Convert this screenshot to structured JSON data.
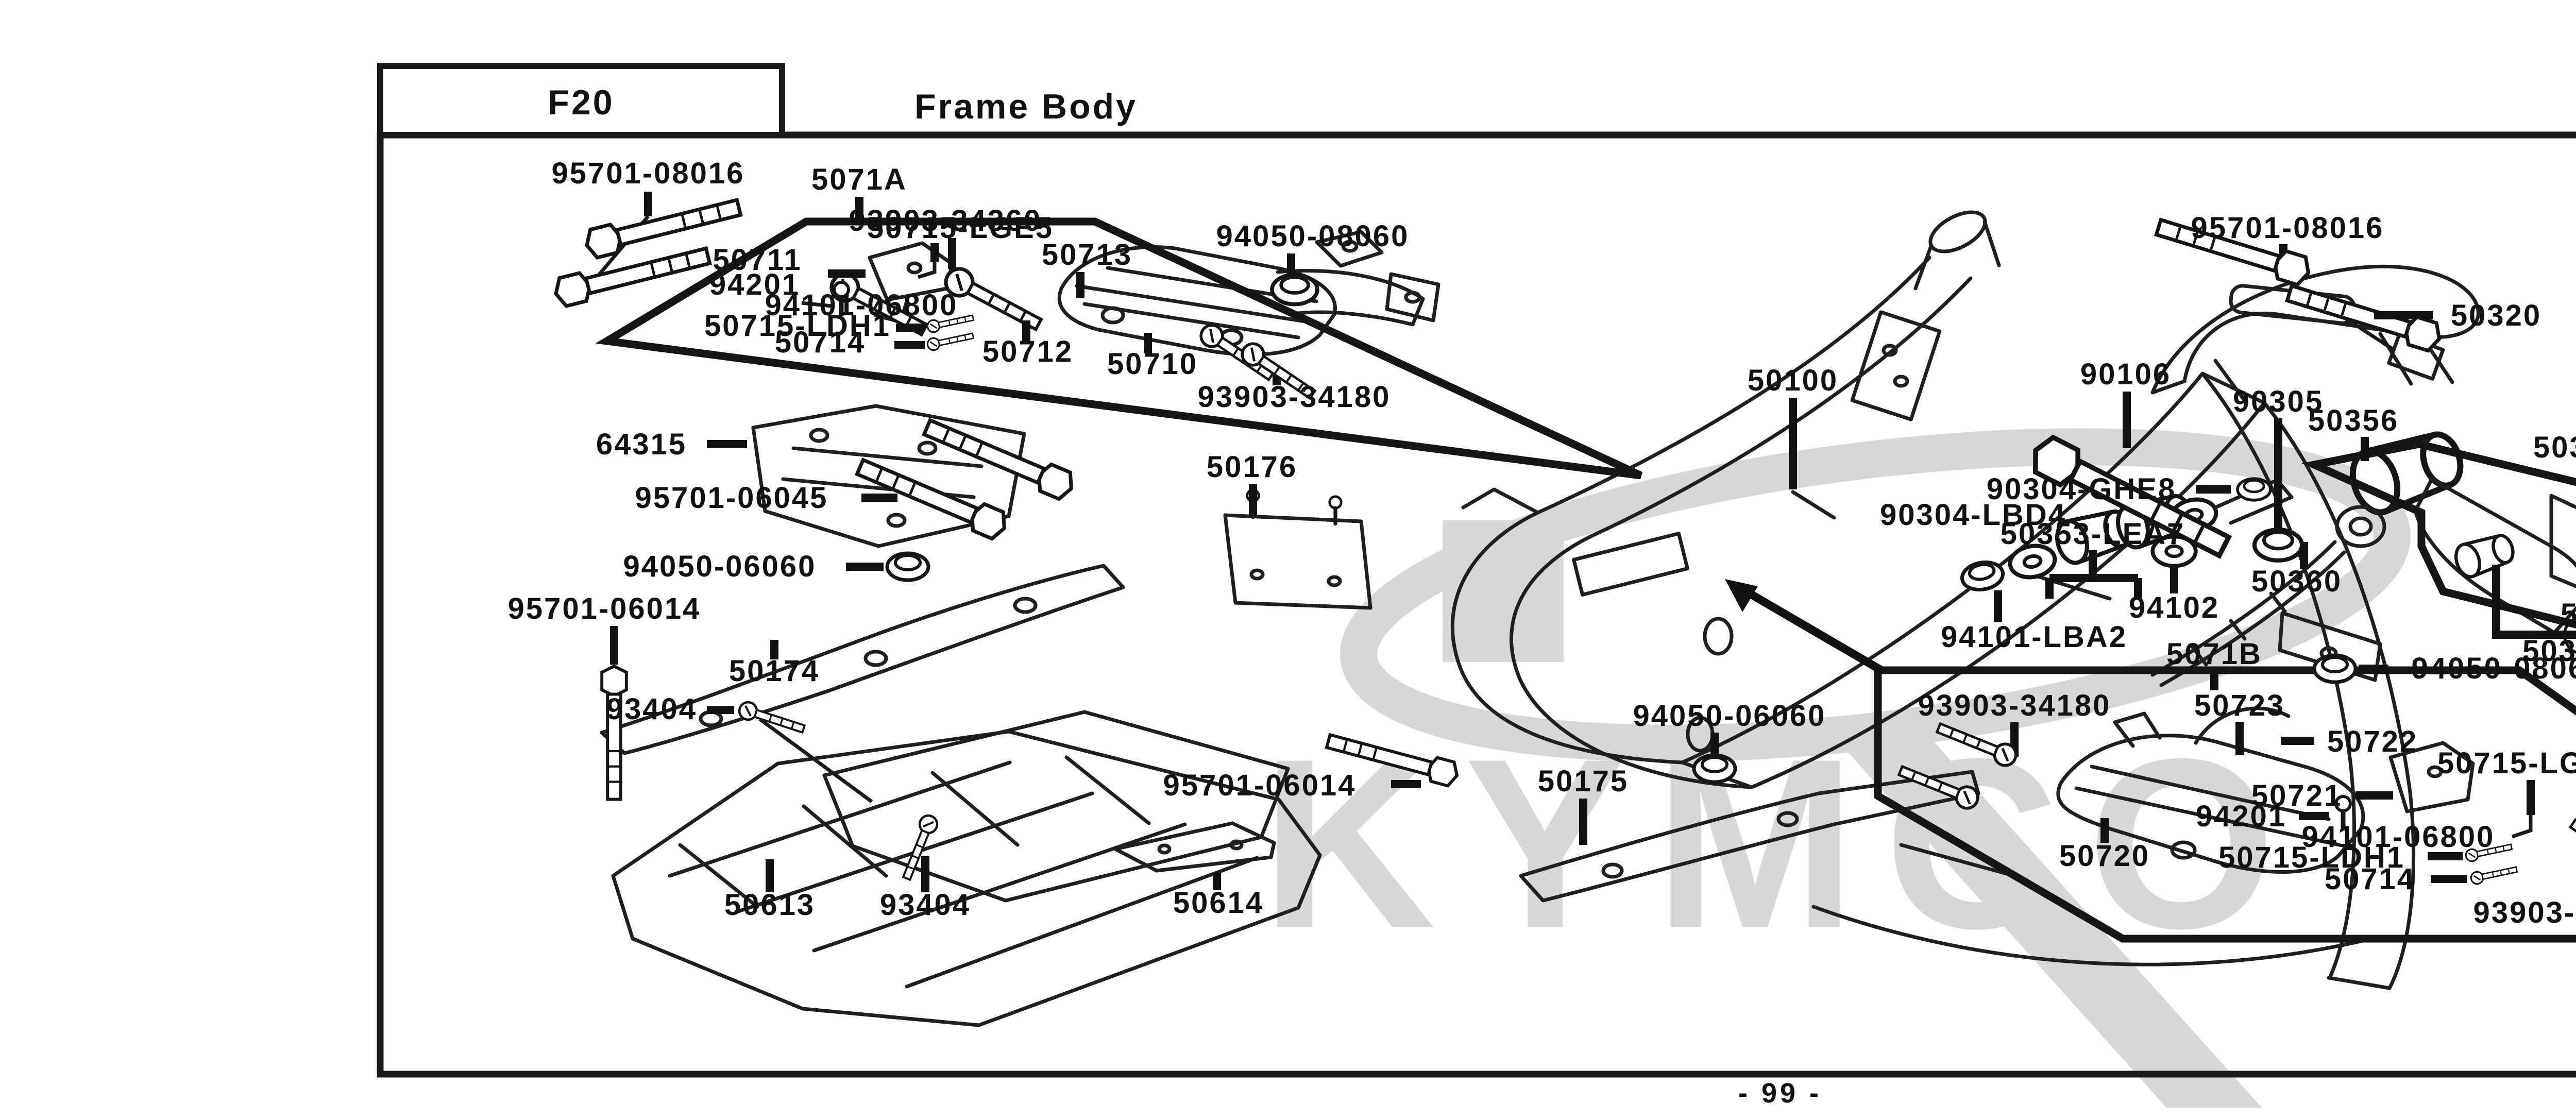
{
  "page": {
    "section_code": "F20",
    "section_title": "Frame Body",
    "page_number": "- 99 -"
  },
  "watermark": {
    "brand": "KYMCO"
  },
  "part_labels": [
    "95701-08016",
    "5071A",
    "93903-34360",
    "50715-LGE5",
    "50713",
    "94050-08060",
    "50711",
    "94201",
    "94101-06800",
    "50715-LDH1",
    "50714",
    "50712",
    "50710",
    "93903-34180",
    "50176",
    "64315",
    "95701-06045",
    "94050-06060",
    "95701-06014",
    "50174",
    "93404",
    "50613",
    "93404",
    "50614",
    "95701-06014",
    "50175",
    "94050-06060",
    "50100",
    "90106",
    "90305",
    "50356",
    "50350",
    "50356",
    "90305",
    "90106",
    "90117",
    "90304-GHE8",
    "90304-LBD4",
    "50353-LEA7",
    "50360",
    "94102",
    "94101-LBA2",
    "5071B",
    "94050-08060",
    "50353-KGN7",
    "50364",
    "93903-34180",
    "50723",
    "50722",
    "50715-LGE5",
    "50721",
    "94201",
    "94101-06800",
    "50720",
    "50715-LDH1",
    "50714",
    "93903-34360",
    "95701-08016",
    "95701-08016",
    "50320"
  ]
}
